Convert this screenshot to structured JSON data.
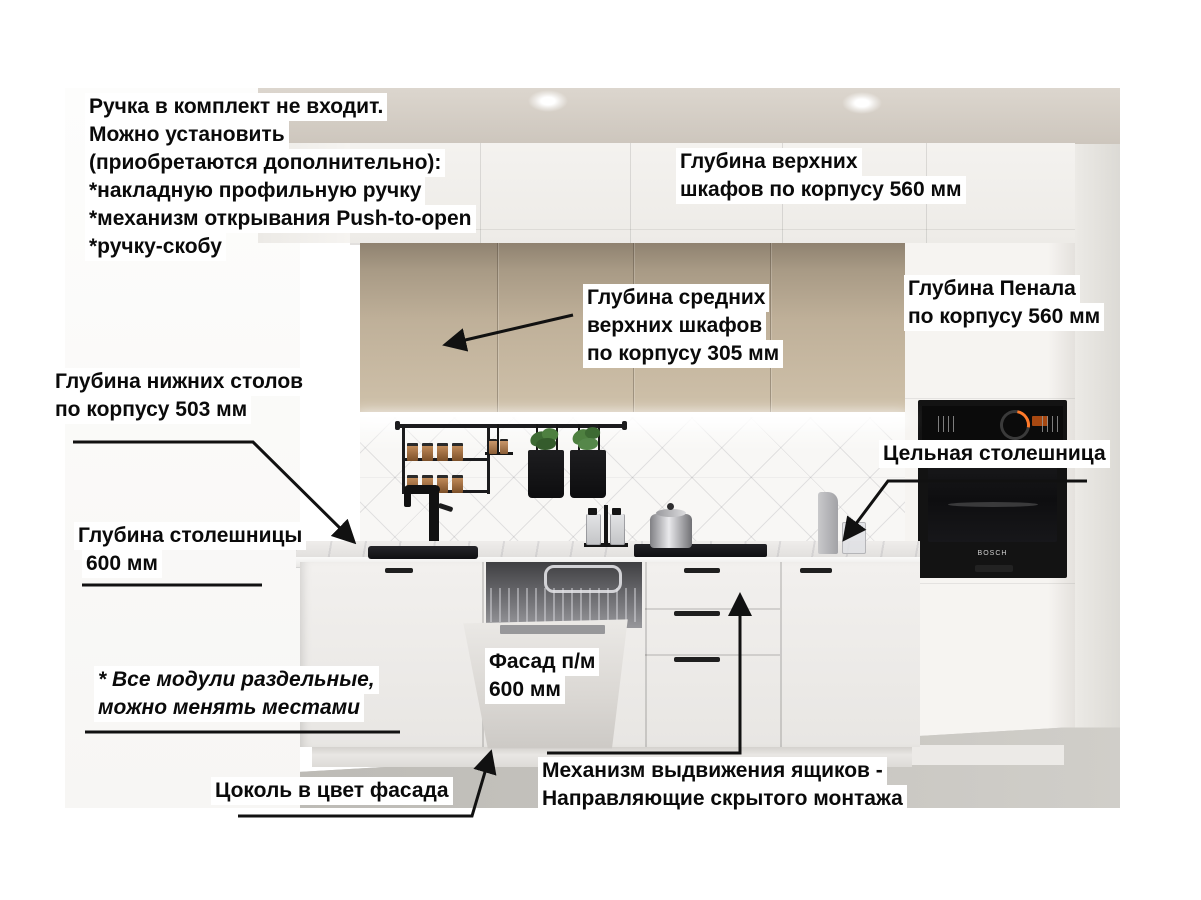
{
  "annotations": {
    "handles_note": {
      "lines": [
        "Ручка в комплект не входит.",
        "Можно установить",
        "(приобретаются дополнительно):",
        "*накладную профильную ручку",
        "*механизм открывания Push-to-open",
        "*ручку-скобу"
      ]
    },
    "upper_cabinets_depth": {
      "lines": [
        "Глубина верхних",
        "шкафов по корпусу 560 мм"
      ]
    },
    "middle_upper_cabinets_depth": {
      "lines": [
        "Глубина средних",
        "верхних шкафов",
        "по корпусу 305 мм"
      ]
    },
    "tall_cabinet_depth": {
      "lines": [
        "Глубина Пенала",
        "по корпусу 560 мм"
      ]
    },
    "base_cabinets_depth": {
      "lines": [
        "Глубина нижних столов",
        "по корпусу 503 мм"
      ]
    },
    "solid_countertop": {
      "lines": [
        "Цельная столешница"
      ]
    },
    "countertop_depth": {
      "lines": [
        "Глубина столешницы",
        "600 мм"
      ]
    },
    "dishwasher_facade": {
      "lines": [
        "Фасад п/м",
        "600 мм"
      ]
    },
    "modules_note": {
      "lines": [
        "* Все модули раздельные,",
        "можно менять местами"
      ]
    },
    "plinth_note": {
      "lines": [
        "Цоколь в цвет фасада"
      ]
    },
    "drawer_mechanism": {
      "lines": [
        "Механизм выдвижения ящиков -",
        "Направляющие скрытого монтажа"
      ]
    }
  },
  "scene": {
    "oven_brand": "BOSCH",
    "colors": {
      "label_background": "#ffffff",
      "label_text": "#0a0a0a",
      "arrow": "#111111",
      "beige_cabinet": "#bfb099",
      "white_cabinet": "#f2f0ee",
      "countertop": "#efedeb",
      "oven_black": "#131313",
      "floor_concrete": "#c8c6c1",
      "plant_green": "#4e8040"
    }
  }
}
